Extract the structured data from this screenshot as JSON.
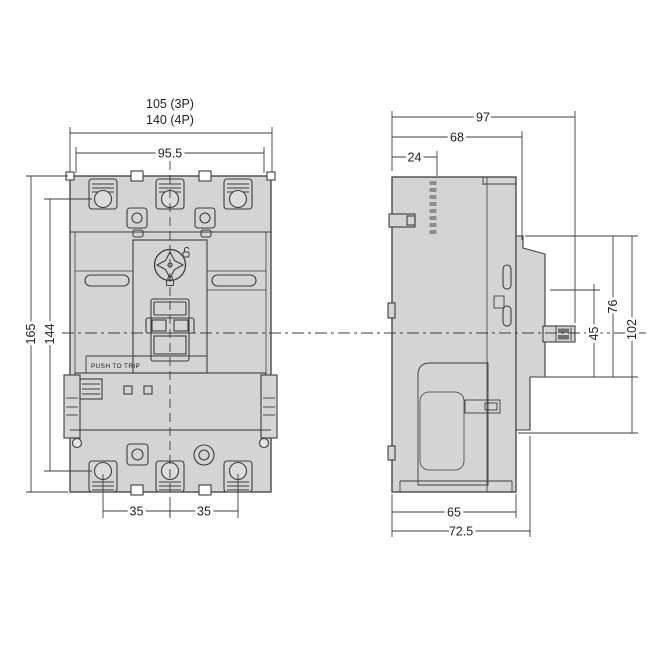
{
  "drawing": {
    "kind": "dimensional-outline-technical-drawing",
    "subject": "molded-case circuit breaker (3P) front and side views",
    "units": "mm",
    "colors": {
      "background": "#ffffff",
      "body_fill": "#d4d4d4",
      "line": "#3d3d3d",
      "thread_line": "#6f6f6f",
      "dim_text": "#222222"
    },
    "front_view": {
      "name": "front view",
      "push_to_trip": "PUSH TO TRIP",
      "dimensions": {
        "overall_width_3p": "105 (3P)",
        "overall_width_4p": "140 (4P)",
        "body_width": "95.5",
        "overall_height": "165",
        "terminal_span_height": "144",
        "pole_pitch_1": "35",
        "pole_pitch_2": "35"
      }
    },
    "side_view": {
      "name": "side view",
      "dimensions": {
        "overall_depth_with_handle": "97",
        "depth_to_front_face": "68",
        "top_step_depth": "24",
        "handle_cutout_height": "45",
        "escutcheon_height_76": "76",
        "escutcheon_height_102": "102",
        "base_depth": "65",
        "base_depth_with_trim": "72.5"
      }
    }
  }
}
